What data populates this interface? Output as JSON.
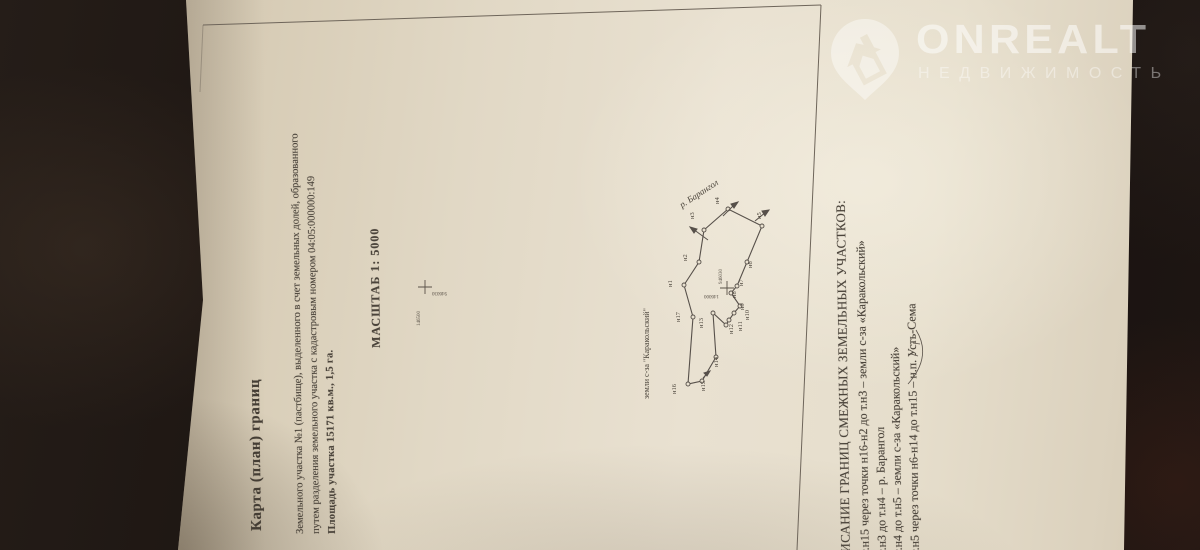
{
  "photo": {
    "background_color": "#1b1411",
    "paper_color": "#e6decc",
    "ink_color": "#4b443b"
  },
  "watermark": {
    "brand": "ONREALT",
    "subtitle": "НЕДВИЖИМОСТЬ",
    "icon": "house-location-pin-icon"
  },
  "document": {
    "title": "Карта (план)  границ",
    "description_lines": [
      "Земельного  участка №1 (пастбище),  выделенного в счет земельных долей, образованного",
      "путем разделения земельного участка с кадастровым номером 04:05:000000:149",
      "Площадь участка 15171 кв.м., 1,5 га."
    ],
    "scale_label": "МАСШТАБ 1: 5000",
    "map": {
      "river_label": "р. Барангол",
      "adjacent_land_label": "земли с-за \"Каракольский\"",
      "grid_crosses": [
        {
          "vertical_label": "946030",
          "horizontal_label": "146000"
        },
        {
          "vertical_label": "146500",
          "horizontal_label": "946030"
        }
      ],
      "points": [
        {
          "label": "н1"
        },
        {
          "label": "н2"
        },
        {
          "label": "н3"
        },
        {
          "label": "н4"
        },
        {
          "label": "н5"
        },
        {
          "label": "н6"
        },
        {
          "label": "н7"
        },
        {
          "label": "н8"
        },
        {
          "label": "н9"
        },
        {
          "label": "н10"
        },
        {
          "label": "н11"
        },
        {
          "label": "н12"
        },
        {
          "label": "н13"
        },
        {
          "label": "н14"
        },
        {
          "label": "н15"
        },
        {
          "label": "н16"
        },
        {
          "label": "н17"
        }
      ]
    },
    "adjacency": {
      "heading": "ОПИСАНИЕ ГРАНИЦ СМЕЖНЫХ ЗЕМЕЛЬНЫХ УЧАСТКОВ:",
      "lines": [
        "от т.н15 через точки н16-н2 до т.н3 – земли с-за «Каракольский»",
        "от т.н3 до т.н4 – р. Барангол",
        "от т.н4 до т.н5 – земли с-за «Каракольский»",
        "от т.н5 через точки н6-н14 до т.н15 – н.п. Усть-Сема"
      ]
    }
  }
}
